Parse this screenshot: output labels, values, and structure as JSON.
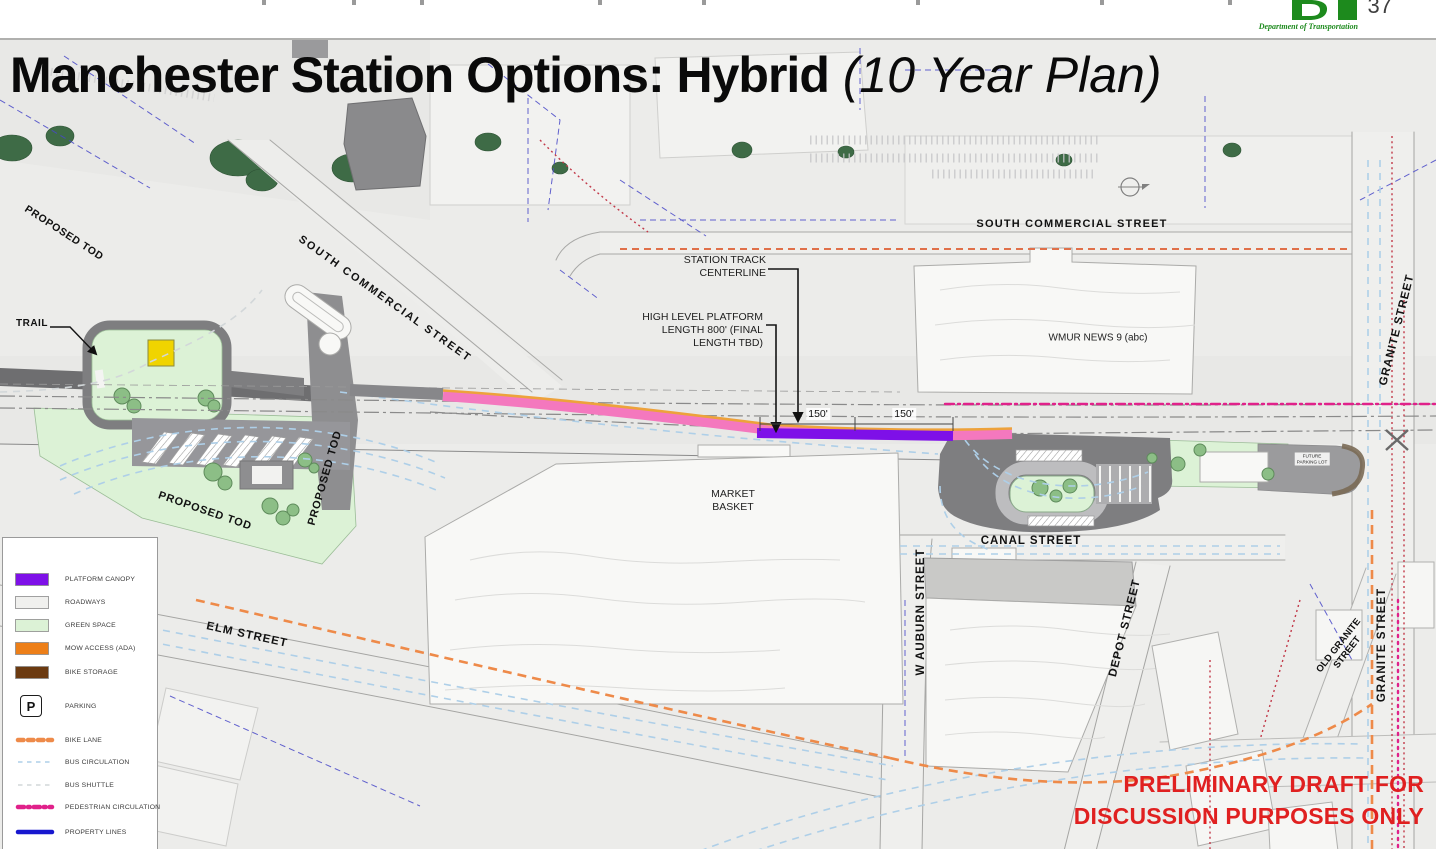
{
  "header": {
    "page_number": "37",
    "dot_tagline": "Department of Transportation"
  },
  "title": {
    "main": "Manchester Station Options: Hybrid",
    "suffix": " (10 Year Plan)"
  },
  "disclaimer": {
    "line1": "PRELIMINARY DRAFT FOR",
    "line2": "DISCUSSION PURPOSES ONLY"
  },
  "map": {
    "streets": {
      "proposed_tod_upper": "PROPOSED TOD",
      "south_commercial_diag": "SOUTH COMMERCIAL STREET",
      "south_commercial_top": "SOUTH COMMERCIAL STREET",
      "trail": "TRAIL",
      "proposed_tod_lower": "PROPOSED TOD",
      "proposed_tod_vertical": "PROPOSED TOD",
      "elm": "ELM STREET",
      "canal": "CANAL STREET",
      "w_auburn": "W AUBURN STREET",
      "depot": "DEPOT STREET",
      "granite_upper": "GRANITE STREET",
      "granite_lower": "GRANITE STREET",
      "old_granite_line1": "OLD GRANITE",
      "old_granite_line2": "STREET"
    },
    "buildings": {
      "market_basket_line1": "MARKET",
      "market_basket_line2": "BASKET",
      "wmur": "WMUR NEWS 9 (abc)",
      "future_parking_line1": "FUTURE",
      "future_parking_line2": "PARKING LOT"
    },
    "annotations": {
      "station_track_line1": "STATION TRACK",
      "station_track_line2": "CENTERLINE",
      "platform_line1": "HIGH LEVEL PLATFORM",
      "platform_line2": "LENGTH 800' (FINAL",
      "platform_line3": "LENGTH TBD)",
      "dim_left": "150'",
      "dim_right": "150'"
    }
  },
  "legend": {
    "items": [
      {
        "label": "STATION PLATFORM",
        "type": "swatch",
        "color": "#f478be"
      },
      {
        "label": "PLATFORM CANOPY",
        "type": "swatch",
        "color": "#7e10e8"
      },
      {
        "label": "ROADWAYS",
        "type": "swatch",
        "color": "#f0f0ee"
      },
      {
        "label": "GREEN SPACE",
        "type": "swatch",
        "color": "#dcf2d6"
      },
      {
        "label": "MOW ACCESS (ADA)",
        "type": "swatch",
        "color": "#ed7f18"
      },
      {
        "label": "BIKE STORAGE",
        "type": "swatch",
        "color": "#6b3a10"
      },
      {
        "label": "PARKING",
        "type": "icon",
        "icon_text": "P"
      },
      {
        "label": "BIKE LANE",
        "type": "line",
        "color": "#ee8a49",
        "width": "4.5",
        "dash": "5.5 4.5"
      },
      {
        "label": "BUS CIRCULATION",
        "type": "line",
        "color": "#aecfe8",
        "width": "1.6",
        "dash": "4.5 4.5"
      },
      {
        "label": "BUS SHUTTLE",
        "type": "line",
        "color": "#d2d7d9",
        "width": "1.6",
        "dash": "4.5 4.5"
      },
      {
        "label": "PEDESTRIAN CIRCULATION",
        "type": "line",
        "color": "#e0218a",
        "width": "4.5",
        "dash": "6 4 1.8 4"
      },
      {
        "label": "PROPERTY LINES",
        "type": "line",
        "color": "#1717cf",
        "width": "4.5",
        "dash": "none"
      }
    ]
  },
  "colors": {
    "station_platform": "#f478be",
    "platform_canopy": "#7e10e8",
    "roadways": "#f0f0ee",
    "green_space": "#dcf2d6",
    "mow_access": "#ed7f18",
    "bike_storage": "#6b3a10",
    "bike_lane": "#ee8a49",
    "bus_circulation": "#aecfe8",
    "bus_shuttle": "#d2d7d9",
    "pedestrian_circulation": "#e0218a",
    "property_lines": "#1717cf",
    "dark_roadway": "#7e7e80",
    "map_background": "#ececea",
    "disclaimer_red": "#e02020",
    "dot_green": "#1d8a1d",
    "marker_yellow": "#f0d400"
  }
}
